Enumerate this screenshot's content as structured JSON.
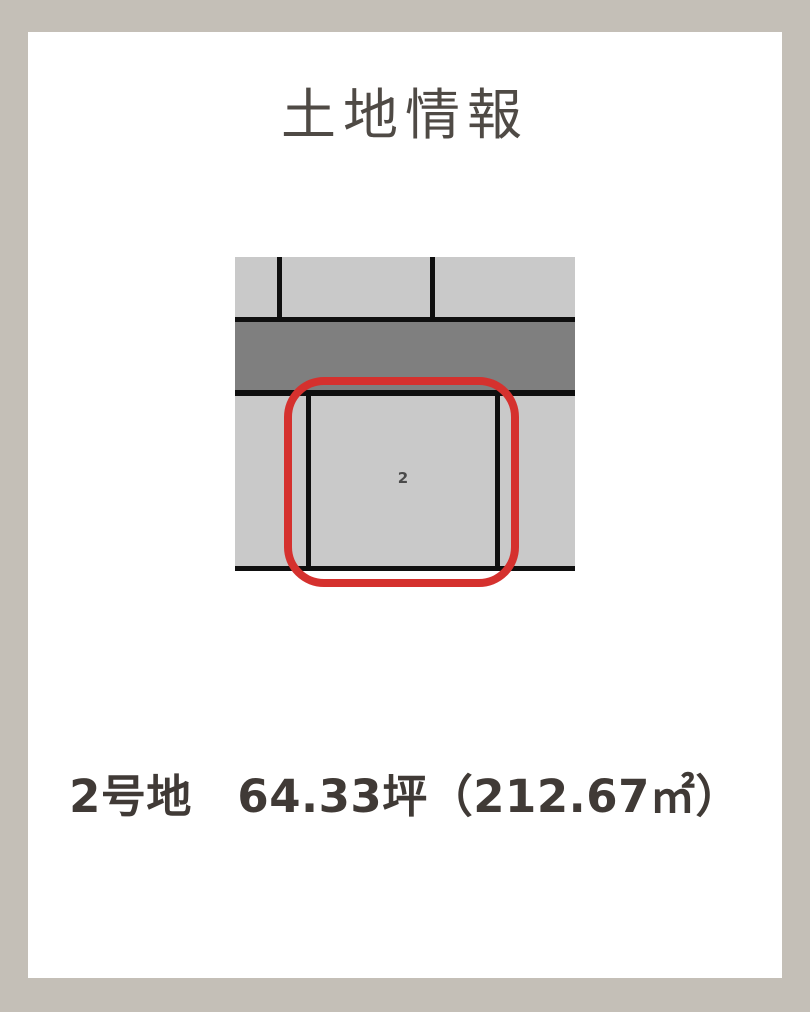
{
  "page": {
    "frame_color": "#c4bfb7",
    "card_color": "#ffffff"
  },
  "title": "土地情報",
  "plot_map": {
    "plot_number": "2",
    "colors": {
      "parcel": "#c9c9c9",
      "road": "#7f7f7f",
      "line": "#0f0f0f",
      "highlight": "#d5312e",
      "plot_label": "#4a4a4a"
    }
  },
  "caption": "2号地　64.33坪（212.67㎡）"
}
